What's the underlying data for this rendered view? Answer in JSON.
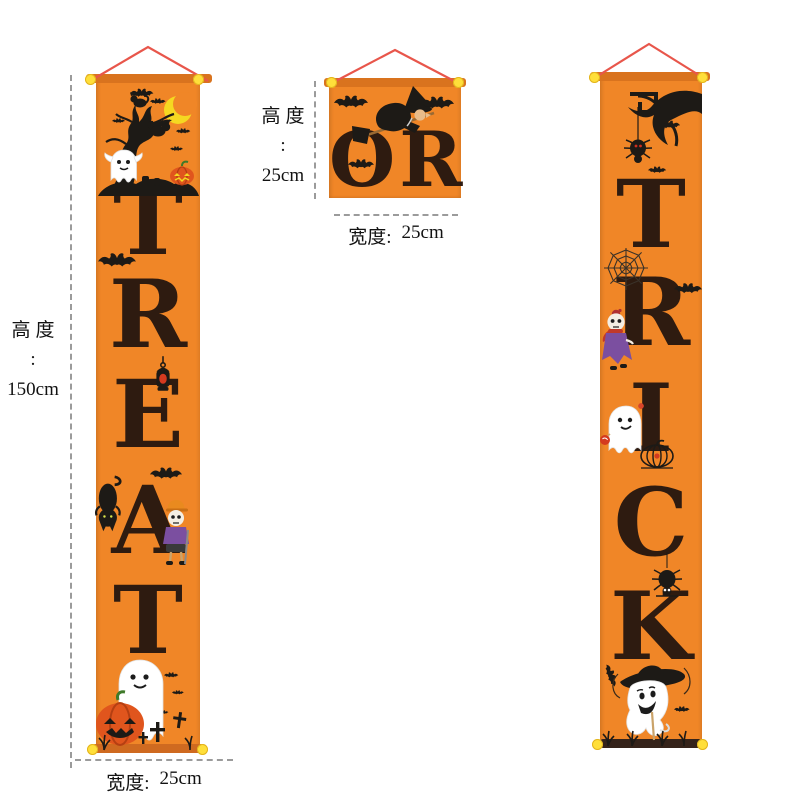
{
  "colors": {
    "bg": "#ffffff",
    "cloth": "#f08627",
    "rod": "#d9731e",
    "roddark": "#35231a",
    "letter": "#2e1b10",
    "string": "#e8564b",
    "dot": "#ffdf3a",
    "dash": "#9b9b9b",
    "anntext": "#121212",
    "moon": "#f5d821",
    "silhouette": "#1d1a16",
    "pumpkin": "#e0551d",
    "pumpkindark": "#b53f12",
    "stem": "#3f7a2a",
    "robe": "#7b4fa0",
    "skin": "#e9bc8a",
    "broom": "#9a6a33",
    "cap": "#e98a1f",
    "glow": "#d43a1f",
    "scarf": "#c0392b"
  },
  "banners": {
    "treat": {
      "word": "TREAT",
      "letters": [
        "T",
        "R",
        "E",
        "A",
        "T"
      ]
    },
    "or": {
      "word": "OR"
    },
    "trick": {
      "word": "TRICK",
      "letters": [
        "T",
        "R",
        "I",
        "C",
        "K"
      ]
    }
  },
  "annotations": {
    "left_height": {
      "label": "高度",
      "colon": ":",
      "value": "150cm"
    },
    "left_width": {
      "label": "宽度:",
      "value": "25cm"
    },
    "mid_height": {
      "label": "高度",
      "colon": ":",
      "value": "25cm"
    },
    "mid_width": {
      "label": "宽度:",
      "value": "25cm"
    }
  }
}
